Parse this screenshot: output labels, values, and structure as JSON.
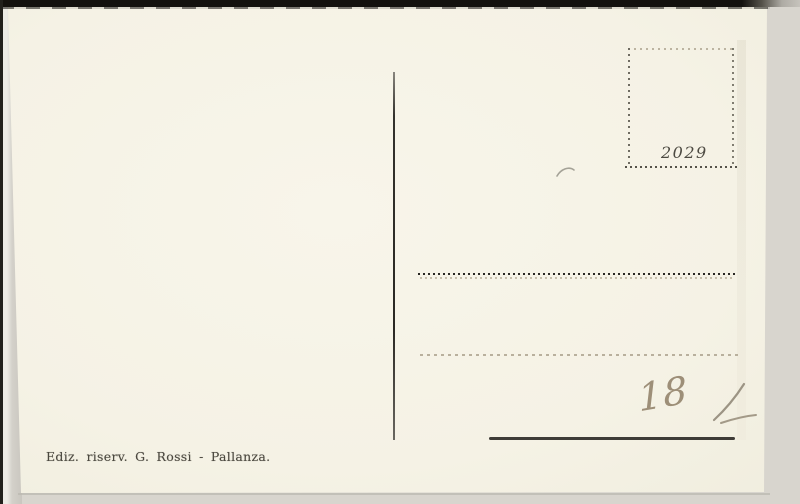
{
  "postcard": {
    "stamp_box_number": "2029",
    "publisher_imprint": "Ediz. riserv. G. Rossi - Pallanza.",
    "handwritten_note": "18",
    "colors": {
      "card_paper": "#f6f3e7",
      "scan_background": "#d8d5ce",
      "scan_border": "#13110e",
      "print_ink": "#4b483f",
      "address_dots": "#282622",
      "faint_dots": "#b2a995",
      "solid_line": "#3e3c37",
      "pencil": "#92826a"
    }
  }
}
